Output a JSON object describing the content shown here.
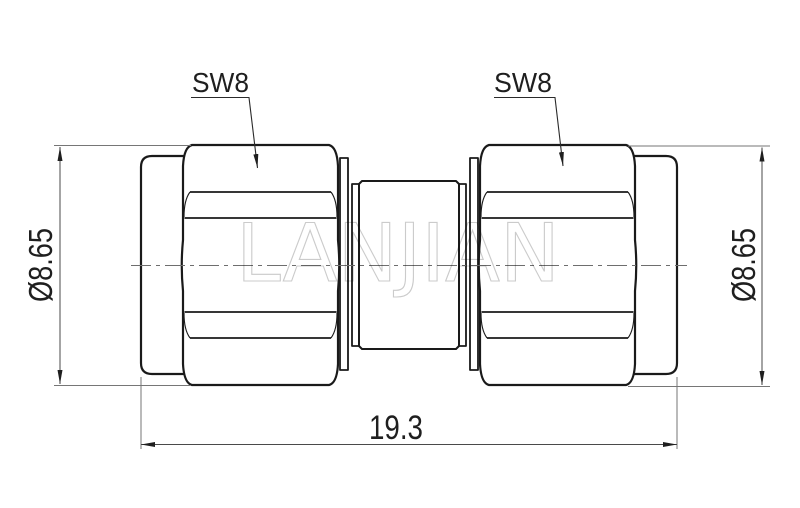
{
  "drawing": {
    "background_color": "#ffffff",
    "outline_color": "#1a1a1a",
    "dimension_line_color": "#767676",
    "text_color": "#1f1f1f",
    "labels": {
      "left_hex_wrench": "SW8",
      "right_hex_wrench": "SW8",
      "left_diameter": "Ø8.65",
      "right_diameter": "Ø8.65",
      "overall_length": "19.3"
    },
    "watermark": {
      "text": "LANJIAN",
      "color": "#cbcbcb"
    }
  }
}
